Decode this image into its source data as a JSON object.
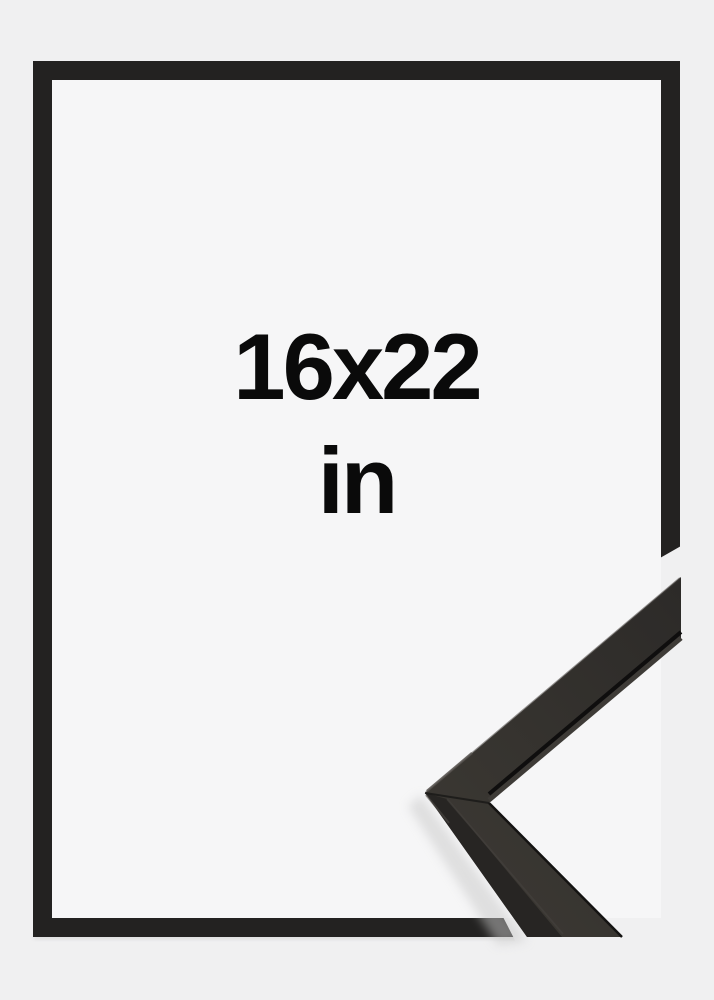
{
  "product": {
    "type_label": "picture-frame-size-mockup",
    "size_label": {
      "line1": "16x22",
      "line2": "in",
      "full": "16x22 in"
    }
  },
  "colors": {
    "background": "#f0f0f1",
    "frame_opening": "#f6f6f7",
    "frame_border": "#232221",
    "label_text": "#0a0a0a",
    "corner_detail_dark": "#2c2a28",
    "corner_detail_light": "#3a3732"
  }
}
